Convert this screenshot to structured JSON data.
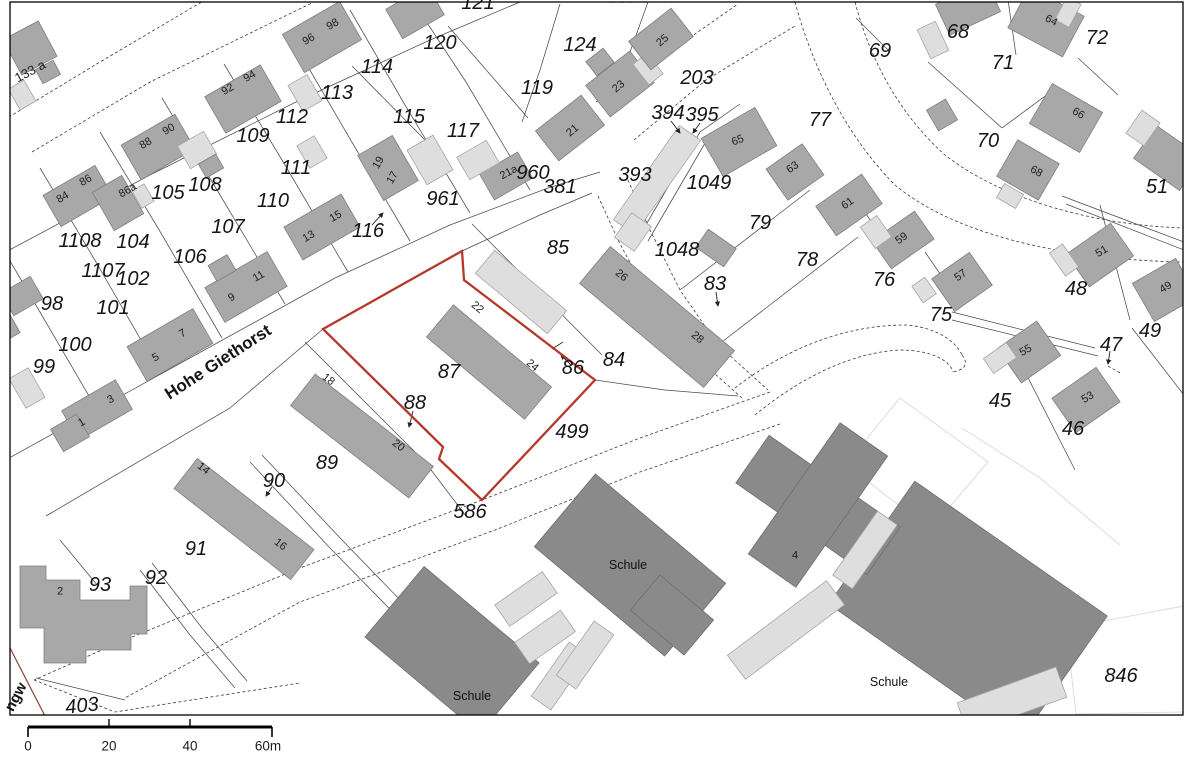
{
  "map": {
    "highlight_color": "#b5392a",
    "street": {
      "label": "Hohe Giethorst",
      "x": 218,
      "y": 362,
      "rot": -33,
      "size": 17
    },
    "street_fragment": {
      "label": "ngw",
      "x": 16,
      "y": 697,
      "rot": -62,
      "size": 15
    },
    "building_names": [
      {
        "t": "Schule",
        "x": 472,
        "y": 696
      },
      {
        "t": "Schule",
        "x": 628,
        "y": 565
      },
      {
        "t": "Schule",
        "x": 889,
        "y": 682
      }
    ],
    "parcel_labels": [
      {
        "t": "120",
        "x": 440,
        "y": 43
      },
      {
        "t": "121",
        "x": 478,
        "y": 3
      },
      {
        "t": "124",
        "x": 580,
        "y": 45
      },
      {
        "t": "119",
        "x": 537,
        "y": 88
      },
      {
        "t": "115",
        "x": 409,
        "y": 117
      },
      {
        "t": "117",
        "x": 463,
        "y": 131
      },
      {
        "t": "114",
        "x": 377,
        "y": 67
      },
      {
        "t": "113",
        "x": 337,
        "y": 93
      },
      {
        "t": "112",
        "x": 292,
        "y": 117
      },
      {
        "t": "109",
        "x": 253,
        "y": 136
      },
      {
        "t": "111",
        "x": 296,
        "y": 168
      },
      {
        "t": "110",
        "x": 273,
        "y": 201
      },
      {
        "t": "105",
        "x": 168,
        "y": 193
      },
      {
        "t": "108",
        "x": 205,
        "y": 185
      },
      {
        "t": "104",
        "x": 133,
        "y": 242
      },
      {
        "t": "102",
        "x": 133,
        "y": 279
      },
      {
        "t": "1107",
        "x": 103,
        "y": 271
      },
      {
        "t": "1108",
        "x": 80,
        "y": 241
      },
      {
        "t": "106",
        "x": 190,
        "y": 257
      },
      {
        "t": "107",
        "x": 228,
        "y": 227
      },
      {
        "t": "98",
        "x": 52,
        "y": 304
      },
      {
        "t": "101",
        "x": 113,
        "y": 308
      },
      {
        "t": "100",
        "x": 75,
        "y": 345
      },
      {
        "t": "99",
        "x": 44,
        "y": 367
      },
      {
        "t": "116",
        "x": 368,
        "y": 231
      },
      {
        "t": "961",
        "x": 443,
        "y": 199
      },
      {
        "t": "960",
        "x": 533,
        "y": 173
      },
      {
        "t": "381",
        "x": 560,
        "y": 187
      },
      {
        "t": "203",
        "x": 697,
        "y": 78
      },
      {
        "t": "394",
        "x": 668,
        "y": 113
      },
      {
        "t": "395",
        "x": 702,
        "y": 115
      },
      {
        "t": "393",
        "x": 635,
        "y": 175
      },
      {
        "t": "1049",
        "x": 709,
        "y": 183
      },
      {
        "t": "1048",
        "x": 677,
        "y": 250
      },
      {
        "t": "83",
        "x": 715,
        "y": 284
      },
      {
        "t": "79",
        "x": 760,
        "y": 223
      },
      {
        "t": "78",
        "x": 807,
        "y": 260
      },
      {
        "t": "77",
        "x": 820,
        "y": 120
      },
      {
        "t": "69",
        "x": 880,
        "y": 51
      },
      {
        "t": "68",
        "x": 958,
        "y": 32
      },
      {
        "t": "72",
        "x": 1097,
        "y": 38
      },
      {
        "t": "71",
        "x": 1003,
        "y": 63
      },
      {
        "t": "70",
        "x": 988,
        "y": 141
      },
      {
        "t": "51",
        "x": 1157,
        "y": 187
      },
      {
        "t": "76",
        "x": 884,
        "y": 280
      },
      {
        "t": "75",
        "x": 941,
        "y": 315
      },
      {
        "t": "48",
        "x": 1076,
        "y": 289
      },
      {
        "t": "49",
        "x": 1150,
        "y": 331
      },
      {
        "t": "47",
        "x": 1111,
        "y": 345
      },
      {
        "t": "45",
        "x": 1000,
        "y": 401
      },
      {
        "t": "46",
        "x": 1073,
        "y": 429
      },
      {
        "t": "85",
        "x": 558,
        "y": 248
      },
      {
        "t": "86",
        "x": 573,
        "y": 368
      },
      {
        "t": "84",
        "x": 614,
        "y": 360
      },
      {
        "t": "87",
        "x": 449,
        "y": 372
      },
      {
        "t": "88",
        "x": 415,
        "y": 403
      },
      {
        "t": "499",
        "x": 572,
        "y": 432
      },
      {
        "t": "89",
        "x": 327,
        "y": 463
      },
      {
        "t": "90",
        "x": 274,
        "y": 481
      },
      {
        "t": "91",
        "x": 196,
        "y": 549
      },
      {
        "t": "92",
        "x": 156,
        "y": 578
      },
      {
        "t": "93",
        "x": 100,
        "y": 585
      },
      {
        "t": "403",
        "x": 82,
        "y": 706,
        "r": -6
      },
      {
        "t": "586",
        "x": 470,
        "y": 512
      },
      {
        "t": "846",
        "x": 1121,
        "y": 676
      }
    ],
    "house_labels": [
      {
        "t": "133 a",
        "x": 30,
        "y": 71,
        "r": -28,
        "s": 13
      },
      {
        "t": "96",
        "x": 309,
        "y": 40,
        "r": -30
      },
      {
        "t": "98",
        "x": 333,
        "y": 25,
        "r": -30
      },
      {
        "t": "92",
        "x": 228,
        "y": 90,
        "r": -30
      },
      {
        "t": "94",
        "x": 250,
        "y": 77,
        "r": -30
      },
      {
        "t": "88",
        "x": 146,
        "y": 144,
        "r": -30
      },
      {
        "t": "90",
        "x": 169,
        "y": 130,
        "r": -30
      },
      {
        "t": "84",
        "x": 63,
        "y": 198,
        "r": -30
      },
      {
        "t": "86",
        "x": 86,
        "y": 181,
        "r": -30
      },
      {
        "t": "86a",
        "x": 128,
        "y": 191,
        "r": -30
      },
      {
        "t": "1",
        "x": 82,
        "y": 423,
        "r": -30
      },
      {
        "t": "3",
        "x": 111,
        "y": 400,
        "r": -30
      },
      {
        "t": "5",
        "x": 156,
        "y": 358,
        "r": -30
      },
      {
        "t": "7",
        "x": 183,
        "y": 334,
        "r": -30
      },
      {
        "t": "9",
        "x": 232,
        "y": 298,
        "r": -30
      },
      {
        "t": "11",
        "x": 259,
        "y": 277,
        "r": -30
      },
      {
        "t": "13",
        "x": 309,
        "y": 237,
        "r": -30
      },
      {
        "t": "15",
        "x": 336,
        "y": 217,
        "r": -30
      },
      {
        "t": "19",
        "x": 379,
        "y": 163,
        "r": -60
      },
      {
        "t": "17",
        "x": 393,
        "y": 178,
        "r": -60
      },
      {
        "t": "21a",
        "x": 509,
        "y": 173,
        "r": -28
      },
      {
        "t": "21",
        "x": 573,
        "y": 131,
        "r": -40
      },
      {
        "t": "23",
        "x": 619,
        "y": 87,
        "r": -40
      },
      {
        "t": "25",
        "x": 663,
        "y": 41,
        "r": -40
      },
      {
        "t": "18",
        "x": 328,
        "y": 380,
        "r": 38
      },
      {
        "t": "20",
        "x": 398,
        "y": 446,
        "r": 38
      },
      {
        "t": "14",
        "x": 203,
        "y": 469,
        "r": 38
      },
      {
        "t": "16",
        "x": 280,
        "y": 545,
        "r": 38
      },
      {
        "t": "22",
        "x": 477,
        "y": 308,
        "r": 40
      },
      {
        "t": "24",
        "x": 532,
        "y": 366,
        "r": 40
      },
      {
        "t": "26",
        "x": 621,
        "y": 276,
        "r": 40
      },
      {
        "t": "28",
        "x": 697,
        "y": 338,
        "r": 40
      },
      {
        "t": "65",
        "x": 738,
        "y": 141,
        "r": -22
      },
      {
        "t": "63",
        "x": 793,
        "y": 168,
        "r": -35
      },
      {
        "t": "61",
        "x": 848,
        "y": 204,
        "r": -35
      },
      {
        "t": "59",
        "x": 902,
        "y": 239,
        "r": -35
      },
      {
        "t": "57",
        "x": 961,
        "y": 276,
        "r": -35
      },
      {
        "t": "64",
        "x": 1051,
        "y": 21,
        "r": 28
      },
      {
        "t": "66",
        "x": 1078,
        "y": 114,
        "r": 30
      },
      {
        "t": "68",
        "x": 1036,
        "y": 172,
        "r": 30
      },
      {
        "t": "51",
        "x": 1102,
        "y": 252,
        "r": -30
      },
      {
        "t": "49",
        "x": 1166,
        "y": 288,
        "r": -30
      },
      {
        "t": "55",
        "x": 1026,
        "y": 351,
        "r": -30
      },
      {
        "t": "53",
        "x": 1088,
        "y": 398,
        "r": -30
      },
      {
        "t": "4",
        "x": 795,
        "y": 556,
        "s": 11
      },
      {
        "t": "2",
        "x": 60,
        "y": 592,
        "s": 11
      }
    ],
    "scale_bar": {
      "labels": [
        {
          "t": "0",
          "x": 28
        },
        {
          "t": "20",
          "x": 109
        },
        {
          "t": "40",
          "x": 190
        },
        {
          "t": "60m",
          "x": 268
        }
      ],
      "label_y": 746
    }
  }
}
